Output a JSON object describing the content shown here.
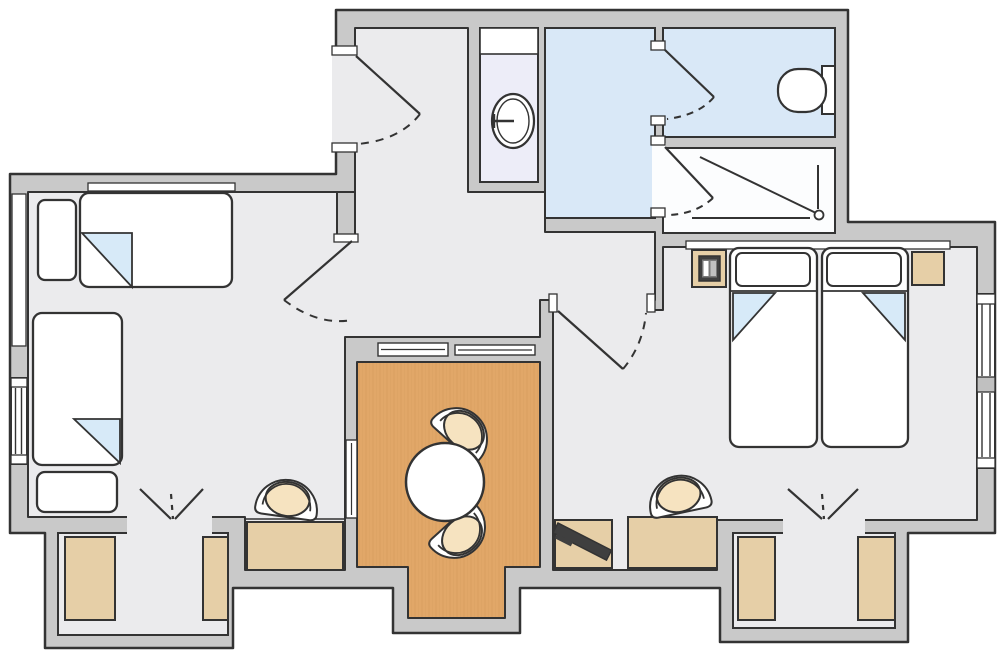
{
  "app": {
    "name": "apartment-floor-plan"
  },
  "colors": {
    "exterior": "#ffffff",
    "wall": "#c9c9c9",
    "line": "#333333",
    "floor": "#ebebed",
    "bath_floor": "#d9e8f7",
    "niche_floor": "#ededf8",
    "shower_floor": "#fcfdfe",
    "balcony_floor": "#e1a768",
    "balcony_grain": "#d3995a",
    "wood": "#e6cfa7",
    "seat": "#f6e3c0",
    "fold": "#d7eaf8",
    "white": "#ffffff",
    "dark": "#3f3f3f",
    "mid": "#7a7a7a",
    "light": "#c0c0c0"
  },
  "rooms": [
    {
      "id": "entry-hall"
    },
    {
      "id": "hallway"
    },
    {
      "id": "living-bedroom-left"
    },
    {
      "id": "washbasin-niche"
    },
    {
      "id": "bathroom"
    },
    {
      "id": "wc"
    },
    {
      "id": "shower-room"
    },
    {
      "id": "bedroom-right"
    },
    {
      "id": "balcony"
    },
    {
      "id": "closet-bay-left"
    },
    {
      "id": "closet-bay-right"
    }
  ],
  "furniture": [
    {
      "id": "single-bed-top",
      "room": "living-bedroom-left"
    },
    {
      "id": "single-bed-left",
      "room": "living-bedroom-left"
    },
    {
      "id": "bench",
      "room": "living-bedroom-left"
    },
    {
      "id": "desk-left",
      "room": "living-bedroom-left"
    },
    {
      "id": "desk-chair-left",
      "room": "living-bedroom-left"
    },
    {
      "id": "double-bed",
      "room": "bedroom-right"
    },
    {
      "id": "nightstand-left",
      "room": "bedroom-right"
    },
    {
      "id": "nightstand-right",
      "room": "bedroom-right"
    },
    {
      "id": "telephone",
      "room": "bedroom-right"
    },
    {
      "id": "desk-right",
      "room": "bedroom-right"
    },
    {
      "id": "desk-chair-right",
      "room": "bedroom-right"
    },
    {
      "id": "tv",
      "room": "hallway"
    },
    {
      "id": "tv-cabinet",
      "room": "hallway"
    },
    {
      "id": "round-table",
      "room": "balcony"
    },
    {
      "id": "balcony-chair-upper",
      "room": "balcony"
    },
    {
      "id": "balcony-chair-lower",
      "room": "balcony"
    },
    {
      "id": "wardrobes",
      "count": 4
    },
    {
      "id": "shelf",
      "room": "washbasin-niche"
    }
  ],
  "fixtures": [
    {
      "id": "washbasin"
    },
    {
      "id": "toilet"
    },
    {
      "id": "shower"
    },
    {
      "id": "entry-door"
    },
    {
      "id": "wc-door"
    },
    {
      "id": "shower-door"
    },
    {
      "id": "bedroom-door"
    },
    {
      "id": "living-door-swing"
    },
    {
      "id": "window-left"
    },
    {
      "id": "window-right"
    },
    {
      "id": "balcony-glazing"
    },
    {
      "id": "curtain-left"
    },
    {
      "id": "curtain-right"
    }
  ]
}
